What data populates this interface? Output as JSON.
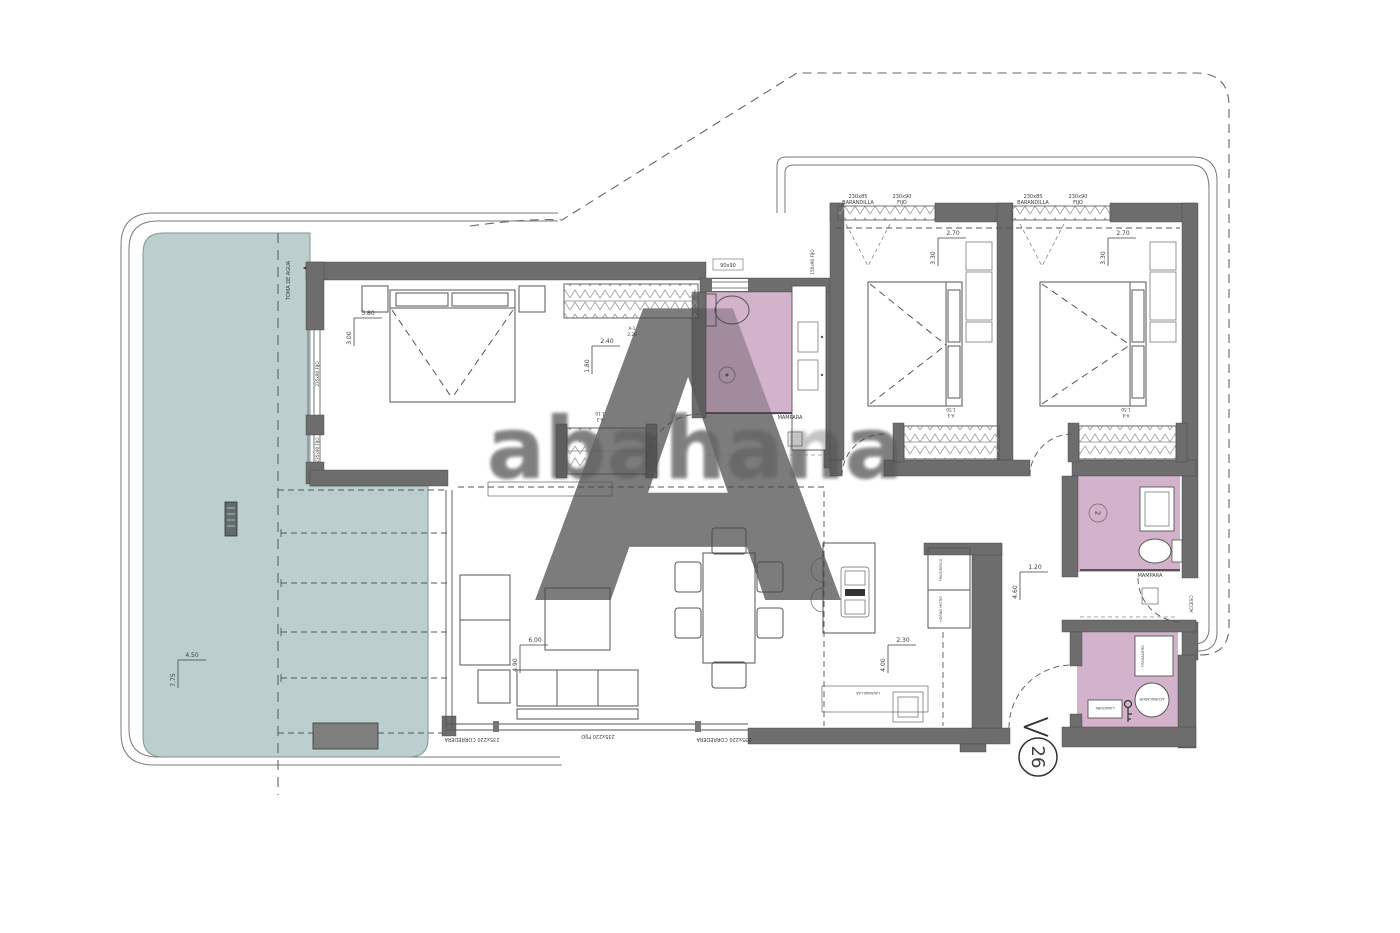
{
  "plot": {
    "number": "26"
  },
  "watermark": {
    "letter": "A",
    "word": "abahana"
  },
  "pool": {
    "water_inlet": "TOMA DE AGUA",
    "width": "4.50",
    "length": "7.75"
  },
  "master": {
    "width": "3.80",
    "depth": "3.00",
    "window1": "235x90 FIJO",
    "window2": "235x90 FIJO"
  },
  "dressing": {
    "width": "2.40",
    "depth": "1.80"
  },
  "closet_a1": {
    "code": "A-1",
    "len": "2.20"
  },
  "closet_a2": {
    "code": "A-2",
    "len": "1.10"
  },
  "closet_a3": {
    "code": "A-3",
    "len": "1.50"
  },
  "closet_a4": {
    "code": "A-4",
    "len": "1.50"
  },
  "bath1": {
    "window": "90x90",
    "side_window": "150x90 FIJO",
    "screen": "MAMPARA"
  },
  "bath2": {
    "shower_num": "2",
    "screen": "MAMPARA"
  },
  "bed2": {
    "rail_size": "230x85",
    "rail": "BARANDILLA",
    "fixed_size": "230x90",
    "fixed": "FIJO",
    "width": "2.70",
    "depth": "3.30"
  },
  "bed3": {
    "rail_size": "230x85",
    "rail": "BARANDILLA",
    "fixed_size": "230x90",
    "fixed": "FIJO",
    "width": "2.70",
    "depth": "3.30"
  },
  "hall": {
    "width": "1.20",
    "length": "4.60"
  },
  "living": {
    "width": "6.00",
    "depth": "4.90"
  },
  "kitchen": {
    "width": "2.30",
    "depth": "4.00",
    "tall_unit1": "FRIGORIFICO",
    "tall_unit2": "HORNO MICRO",
    "appliance": "LAVAVAJILLAS"
  },
  "laundry": {
    "sink": "FREGADERO",
    "boiler": "ACUMULADOR",
    "washer": "LAVADORA"
  },
  "entry": {
    "label": "ACCESO"
  },
  "glazing": {
    "left": "235x220 CORREDERA",
    "center": "235x220 FIJO",
    "right": "235x220 CORREDERA"
  }
}
